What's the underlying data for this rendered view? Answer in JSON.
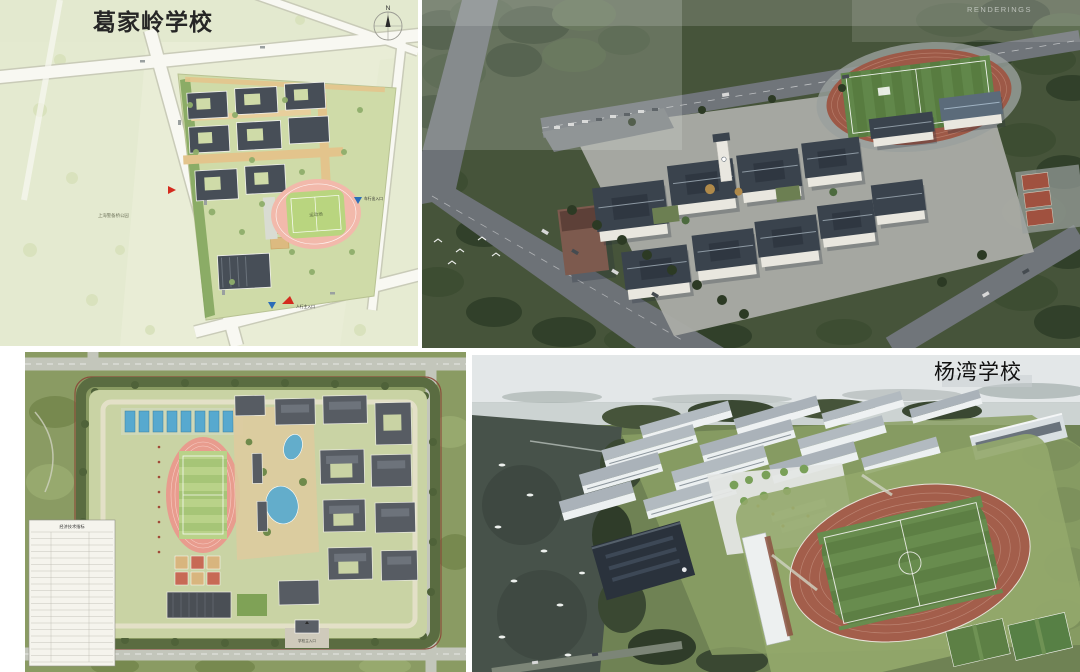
{
  "page": {
    "background_color": "#ffffff"
  },
  "gejialing": {
    "plan": {
      "title": "葛家岭学校",
      "compass_label": "N",
      "park_label": "上海警备桥公园",
      "field_label": "运动场",
      "vehicle_entrance_label": "车行出入口",
      "main_entrance_label": "人行主入口"
    },
    "rendering": {
      "watermark": "RENDERINGS"
    }
  },
  "yangwan": {
    "plan": {
      "table_title": "经济技术指标",
      "entrance_label": "学校主入口"
    },
    "rendering": {
      "title": "杨湾学校"
    }
  },
  "colors": {
    "plan_background": "#e9edd6",
    "plan_building": "#474e57",
    "track_pink": "#f2b9ab",
    "track_terracotta": "#a35e4b",
    "pitch_green": "#5d7f44",
    "tree_green": "#46543a",
    "water_dark": "#47524a",
    "marker_blue": "#2b6cb8",
    "marker_red": "#d42b1e"
  }
}
